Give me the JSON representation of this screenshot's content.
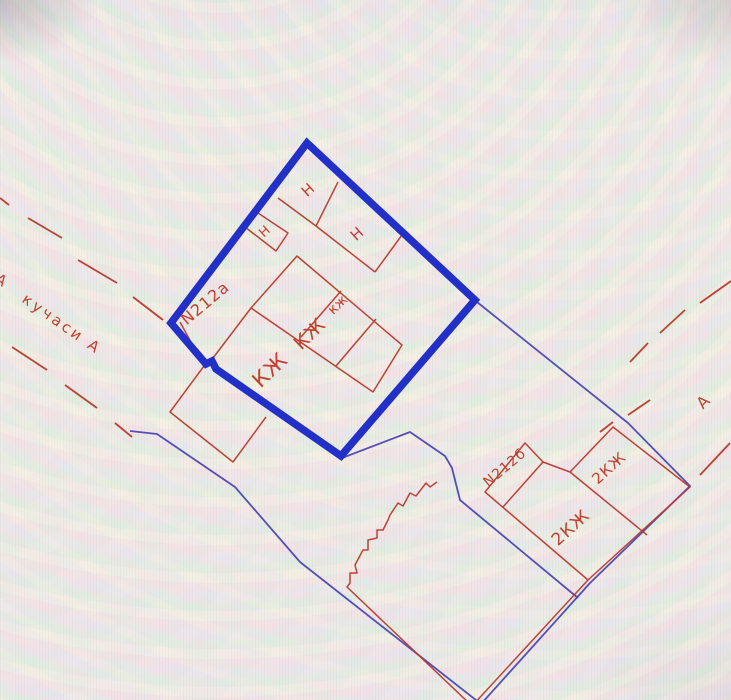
{
  "plan": {
    "title": "cadastral plot drawing",
    "colors": {
      "parcel_highlight": "#2330c7",
      "parcel_thin_blue": "#4a47b5",
      "building_red": "#b9392c",
      "label_red": "#c2402f"
    },
    "region_labels": [
      {
        "text": "Н",
        "x": 308,
        "y": 190,
        "rot": -42,
        "size": 15,
        "spacing": 0
      },
      {
        "text": "Н",
        "x": 265,
        "y": 232,
        "rot": -42,
        "size": 13,
        "spacing": 0
      },
      {
        "text": "Н",
        "x": 357,
        "y": 234,
        "rot": -42,
        "size": 15,
        "spacing": 0
      },
      {
        "text": "N212а",
        "x": 205,
        "y": 303,
        "rot": -40,
        "size": 16,
        "spacing": 1
      },
      {
        "text": "КЖ",
        "x": 270,
        "y": 370,
        "rot": -44,
        "size": 21,
        "spacing": 1
      },
      {
        "text": "КЖ",
        "x": 310,
        "y": 334,
        "rot": -44,
        "size": 19,
        "spacing": 1
      },
      {
        "text": "кж",
        "x": 338,
        "y": 305,
        "rot": -44,
        "size": 14,
        "spacing": 0
      },
      {
        "text": "N212б",
        "x": 505,
        "y": 468,
        "rot": -40,
        "size": 14,
        "spacing": 1
      },
      {
        "text": "2КЖ",
        "x": 571,
        "y": 528,
        "rot": -42,
        "size": 17,
        "spacing": 1
      },
      {
        "text": "2КЖ",
        "x": 609,
        "y": 468,
        "rot": -42,
        "size": 15,
        "spacing": 1
      },
      {
        "text": "кучаси А",
        "x": 62,
        "y": 324,
        "rot": 35,
        "size": 15,
        "spacing": 3
      },
      {
        "text": "А",
        "x": 1,
        "y": 280,
        "rot": 35,
        "size": 15,
        "spacing": 0
      },
      {
        "text": "А",
        "x": 703,
        "y": 402,
        "rot": -45,
        "size": 16,
        "spacing": 0
      }
    ],
    "geometry": {
      "highlighted_parcel": {
        "points": "307,143 475,300 341,456 216,369 212,361 206,364 171,323",
        "closed": true,
        "stroke_width": 7.5
      },
      "thin_parcel_lines": [
        {
          "points": "130,431 157,434 235,487 300,562 481,704"
        },
        {
          "points": "477,302 628,423 690,486 590,583 481,704"
        },
        {
          "points": "342,458 410,432 445,456 452,468 460,500 578,598"
        }
      ],
      "building_lines": [
        {
          "points": "278,198 316,226 375,272",
          "closed": false
        },
        {
          "points": "316,226 338,182",
          "closed": false
        },
        {
          "points": "402,235 375,272",
          "closed": false
        },
        {
          "points": "255,211 288,233 276,251 245,227",
          "closed": false
        },
        {
          "points": "297,256 402,345 373,392 251,308",
          "closed": true
        },
        {
          "points": "251,308 213,358",
          "closed": false
        },
        {
          "points": "341,291 301,337",
          "closed": false
        },
        {
          "points": "376,319 336,366",
          "closed": false
        },
        {
          "points": "180,322 204,366",
          "closed": false
        },
        {
          "points": "204,366 170,412 233,462 266,417",
          "closed": false
        },
        {
          "points": "437,482 430,487 426,483 416,496 410,493 403,506 398,503 390,515 388,520 383,530 377,530 377,538 368,540 368,550 363,550 355,565 357,573 350,573 350,583 347,587 472,706 588,580",
          "closed": false
        },
        {
          "points": "485,492 525,443 543,462 570,472 613,427 690,487 588,580",
          "closed": true
        },
        {
          "points": "503,507 543,462",
          "closed": false
        },
        {
          "points": "570,472 647,535",
          "closed": false
        }
      ],
      "street_dashes": [
        [
          0,
          198,
          9,
          205
        ],
        [
          28,
          218,
          62,
          238
        ],
        [
          78,
          260,
          117,
          283
        ],
        [
          133,
          297,
          163,
          320
        ],
        [
          12,
          347,
          47,
          370
        ],
        [
          65,
          385,
          97,
          408
        ],
        [
          115,
          423,
          132,
          437
        ],
        [
          731,
          281,
          700,
          303
        ],
        [
          685,
          310,
          660,
          333
        ],
        [
          648,
          343,
          630,
          362
        ],
        [
          650,
          400,
          628,
          415
        ],
        [
          613,
          422,
          600,
          432
        ],
        [
          730,
          443,
          700,
          475
        ]
      ]
    }
  }
}
